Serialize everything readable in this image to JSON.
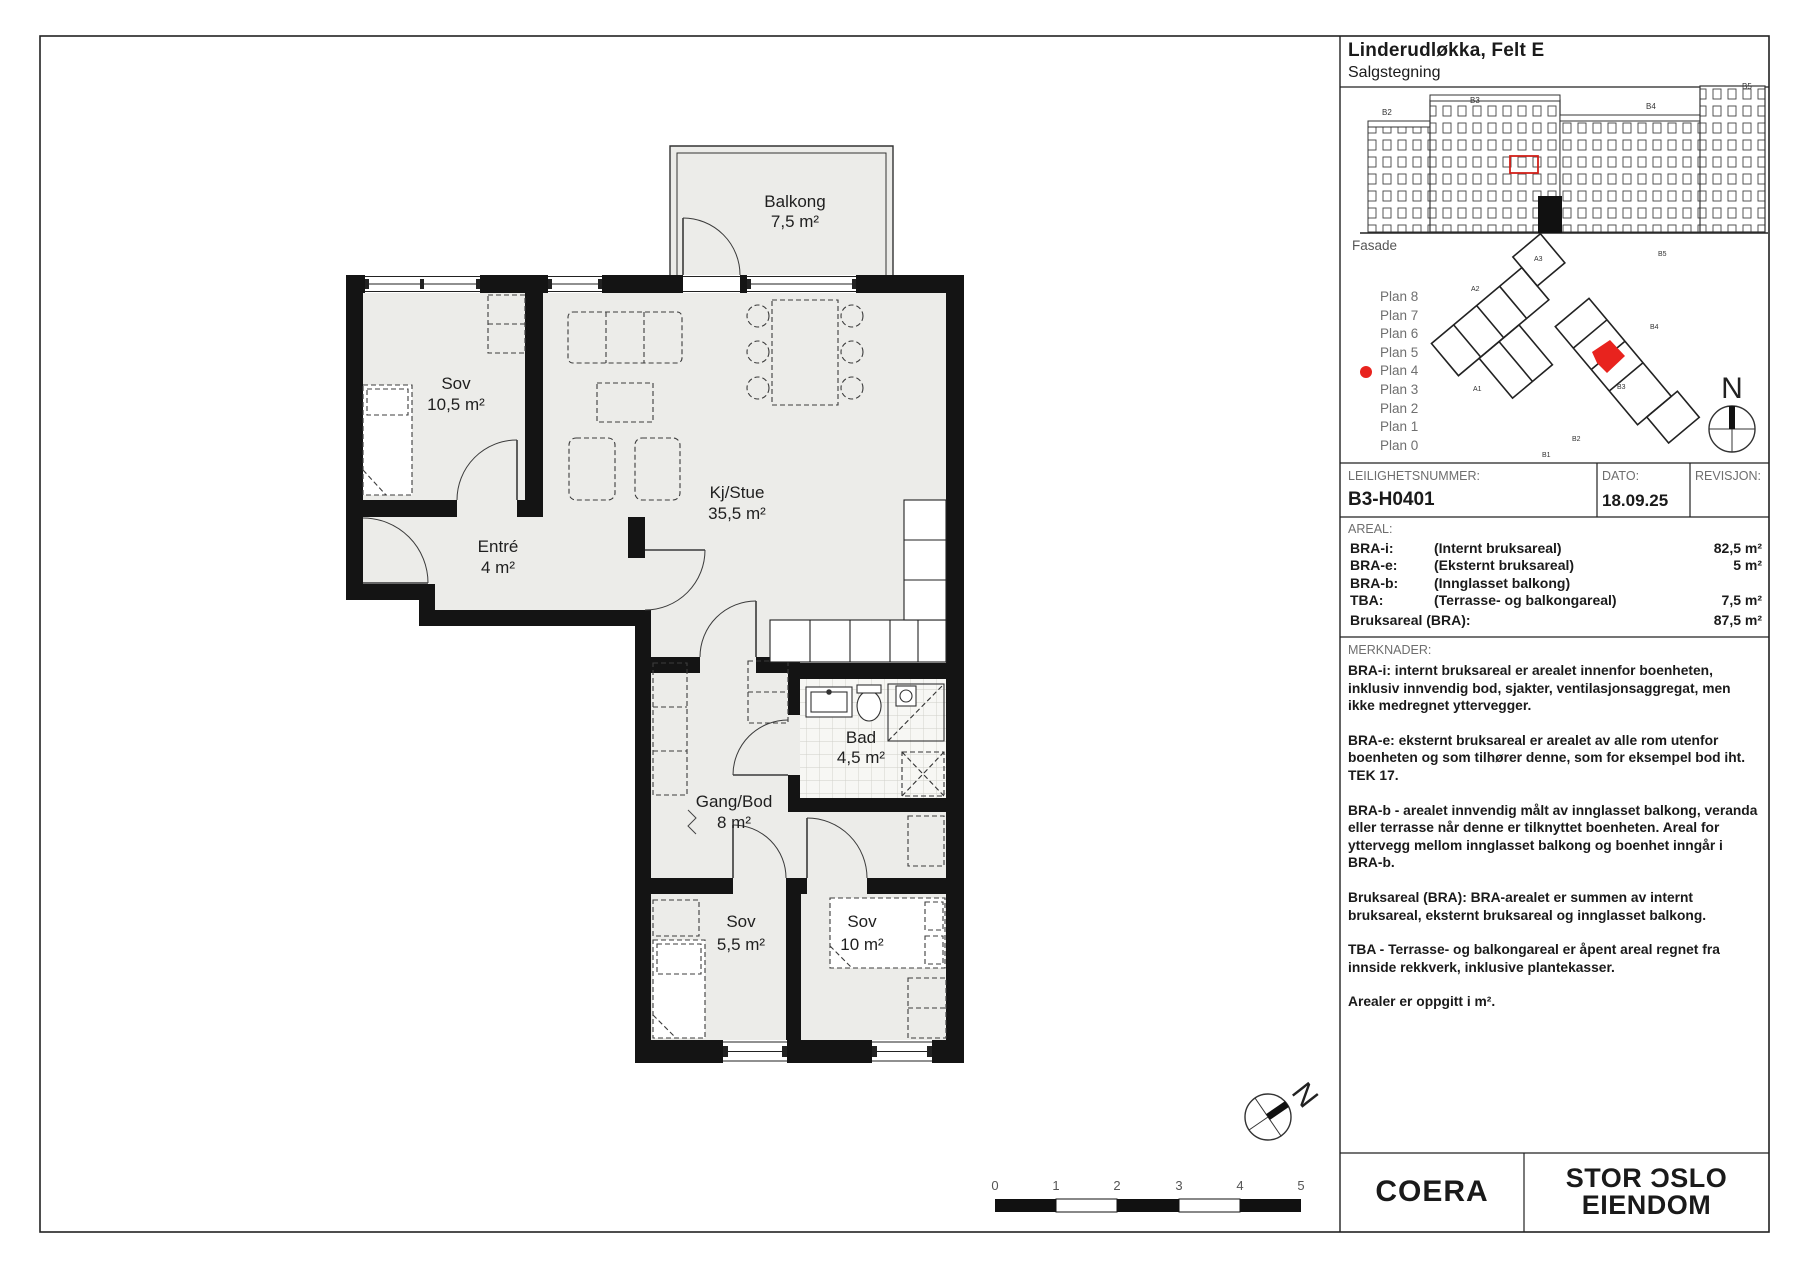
{
  "title": {
    "project": "Linderudløkka, Felt E",
    "subtitle": "Salgstegning"
  },
  "facade": {
    "label": "Fasade",
    "building_labels": [
      "B2",
      "B3",
      "B4",
      "B5"
    ]
  },
  "plans": {
    "items": [
      "Plan 8",
      "Plan 7",
      "Plan 6",
      "Plan 5",
      "Plan 4",
      "Plan 3",
      "Plan 2",
      "Plan 1",
      "Plan 0"
    ],
    "selected": "Plan 4",
    "marker_color": "#e8231e"
  },
  "siteplan": {
    "labels": [
      "A3",
      "A2",
      "A1",
      "B5",
      "B4",
      "B3",
      "B2",
      "B1"
    ],
    "highlight_color": "#e8231e"
  },
  "apartment": {
    "number_label": "LEILIGHETSNUMMER:",
    "number": "B3-H0401",
    "date_label": "DATO:",
    "date": "18.09.25",
    "revision_label": "REVISJON:",
    "revision": ""
  },
  "areal": {
    "label": "AREAL:",
    "rows": [
      {
        "code": "BRA-i:",
        "desc": "(Internt bruksareal)",
        "value": "82,5 m²"
      },
      {
        "code": "BRA-e:",
        "desc": "(Eksternt bruksareal)",
        "value": "5 m²"
      },
      {
        "code": "BRA-b:",
        "desc": "(Innglasset balkong)",
        "value": ""
      },
      {
        "code": "TBA:",
        "desc": "(Terrasse- og balkongareal)",
        "value": "7,5 m²"
      },
      {
        "code": "Bruksareal (BRA):",
        "desc": "",
        "value": "87,5 m²"
      }
    ]
  },
  "merknader": {
    "label": "MERKNADER:",
    "paragraphs": [
      "BRA-i: internt bruksareal er arealet innenfor boenheten, inklusiv innvendig bod, sjakter, ventilasjonsaggregat, men ikke medregnet yttervegger.",
      "BRA-e: eksternt bruksareal er arealet av alle rom utenfor boenheten og som tilhører denne, som for eksempel bod iht. TEK 17.",
      "BRA-b - arealet innvendig målt av innglasset balkong, veranda eller terrasse når denne er tilknyttet boenheten. Areal for yttervegg mellom innglasset balkong og boenhet inngår i BRA-b.",
      "Bruksareal (BRA): BRA-arealet er summen av internt bruksareal, eksternt bruksareal og innglasset balkong.",
      "TBA - Terrasse- og balkongareal er åpent areal regnet fra innside rekkverk, inklusive plantekasser.",
      "Arealer er oppgitt i m²."
    ]
  },
  "rooms": [
    {
      "name": "Balkong",
      "area": "7,5 m²"
    },
    {
      "name": "Sov",
      "area": "10,5 m²"
    },
    {
      "name": "Kj/Stue",
      "area": "35,5 m²"
    },
    {
      "name": "Entré",
      "area": "4 m²"
    },
    {
      "name": "Bad",
      "area": "4,5 m²"
    },
    {
      "name": "Gang/Bod",
      "area": "8 m²"
    },
    {
      "name": "Sov",
      "area": "5,5 m²"
    },
    {
      "name": "Sov",
      "area": "10 m²"
    }
  ],
  "scalebar": {
    "ticks": [
      "0",
      "1",
      "2",
      "3",
      "4",
      "5"
    ]
  },
  "compass": {
    "north": "N"
  },
  "logos": {
    "left": "COERA",
    "right_line1": "STOR ƆSLO",
    "right_line2": "EIENDOM"
  }
}
